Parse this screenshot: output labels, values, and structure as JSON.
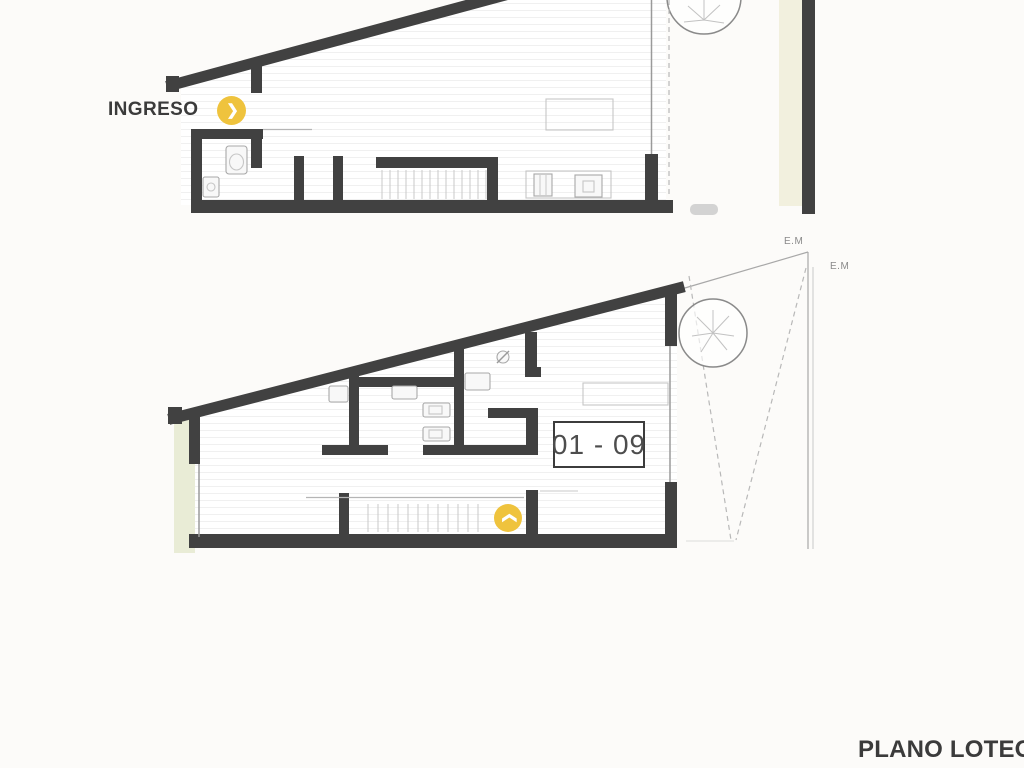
{
  "colors": {
    "bg": "#FCFBF9",
    "wall": "#414141",
    "accent": "#EFC33D",
    "green_strip": "#E9ECD6",
    "cream_strip": "#F2F0DE",
    "text_dark": "#3B3B3B",
    "text_unit": "#4D4D4D",
    "text_muted": "#8A8A8A"
  },
  "labels": {
    "entrance": "INGRESO",
    "unit_number": "01 - 09",
    "em_marker_top": "E.M",
    "em_marker_right": "E.M",
    "sheet_title": "PLANO LOTEO"
  },
  "icons": {
    "entrance_chevron": "❯",
    "stairs_chevron": "❯"
  }
}
